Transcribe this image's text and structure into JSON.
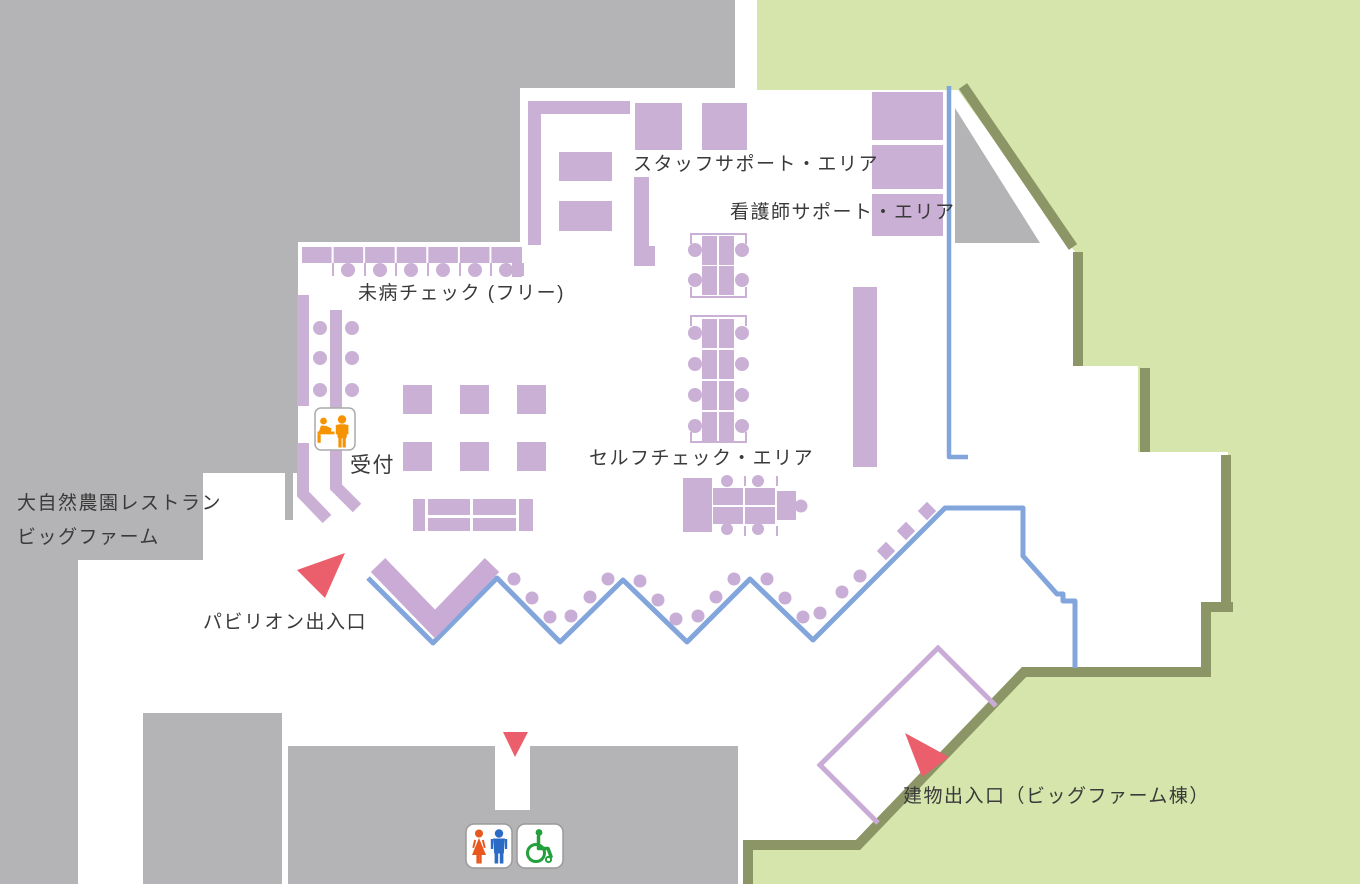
{
  "map": {
    "type": "pavilion-floor-map",
    "areas": {
      "staff_support": {
        "label": "スタッフサポート・エリア"
      },
      "nurse_support": {
        "label": "看護師サポート・エリア"
      },
      "mibyou_check": {
        "label": "未病チェック (フリー)"
      },
      "reception": {
        "label": "受付"
      },
      "self_check": {
        "label": "セルフチェック・エリア"
      }
    },
    "exits": {
      "pavilion": {
        "label": "パビリオン出入口"
      },
      "building": {
        "label": "建物出入口（ビッグファーム棟）"
      }
    },
    "adjacent_facility": {
      "restaurant": {
        "line1": "大自然農園レストラン",
        "line2": "ビッグファーム"
      }
    },
    "icons": {
      "reception": "reception-desk-icon",
      "restroom": "restroom-icon",
      "wheelchair": "wheelchair-accessible-icon",
      "entrance_markers": "red-arrow-triangles"
    },
    "colors": {
      "floor_white": "#ffffff",
      "building_gray": "#b4b4b6",
      "outdoor_green": "#d5e5ab",
      "wall_shadow_olive": "#8c9565",
      "furniture_purple": "#cbb0d6",
      "queue_line_blue": "#82a6db",
      "marker_red": "#eb5e6c",
      "reception_orange": "#f59300",
      "woman_icon": "#e8581e",
      "man_icon": "#2b6bc6",
      "wheelchair_icon": "#22a03c",
      "label_text": "#3a3a3a"
    }
  }
}
